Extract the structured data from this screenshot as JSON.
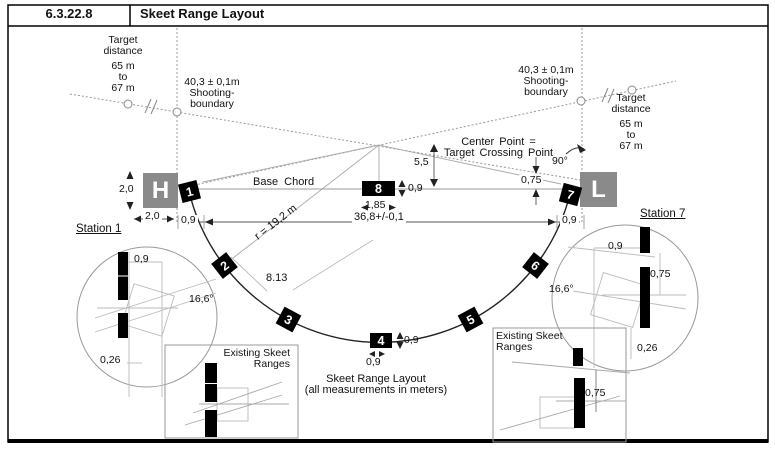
{
  "header": {
    "code": "6.3.22.8",
    "title": "Skeet Range Layout"
  },
  "left_target": {
    "l1": "Target",
    "l2": "distance",
    "l3": "65 m",
    "l4": "to",
    "l5": "67 m"
  },
  "right_target": {
    "l1": "Target",
    "l2": "distance",
    "l3": "65 m",
    "l4": "to",
    "l5": "67 m"
  },
  "left_boundary": {
    "l1": "40,3 ± 0,1m",
    "l2": "Shooting-",
    "l3": "boundary"
  },
  "right_boundary": {
    "l1": "40,3 ± 0,1m",
    "l2": "Shooting-",
    "l3": "boundary"
  },
  "center_point": {
    "l1": "Center Point =",
    "l2": "Target Crossing Point"
  },
  "labels": {
    "base_chord": "Base Chord",
    "radius": "r = 19,2 m",
    "chord_width": "36,8+/-0,1",
    "station_gap": "8.13",
    "right_angle": "90°"
  },
  "dims": {
    "d55": "5,5",
    "d09": "0,9",
    "d185": "1,85",
    "d20": "2,0",
    "d075": "0,75",
    "d166": "16,6°",
    "d026": "0,26"
  },
  "stations": {
    "s1": "1",
    "s2": "2",
    "s3": "3",
    "s4": "4",
    "s5": "5",
    "s6": "6",
    "s7": "7",
    "s8": "8",
    "high_house": "H",
    "low_house": "L"
  },
  "detail_left": {
    "title": "Station 1"
  },
  "detail_right": {
    "title": "Station 7"
  },
  "existing_ranges": {
    "l1": "Existing Skeet",
    "l2": "Ranges"
  },
  "caption": {
    "l1": "Skeet Range Layout",
    "l2": "(all measurements in meters)"
  },
  "colors": {
    "house_gray": "#8a8a8a",
    "station_black": "#000000",
    "construction_line": "#bbbbbb"
  }
}
